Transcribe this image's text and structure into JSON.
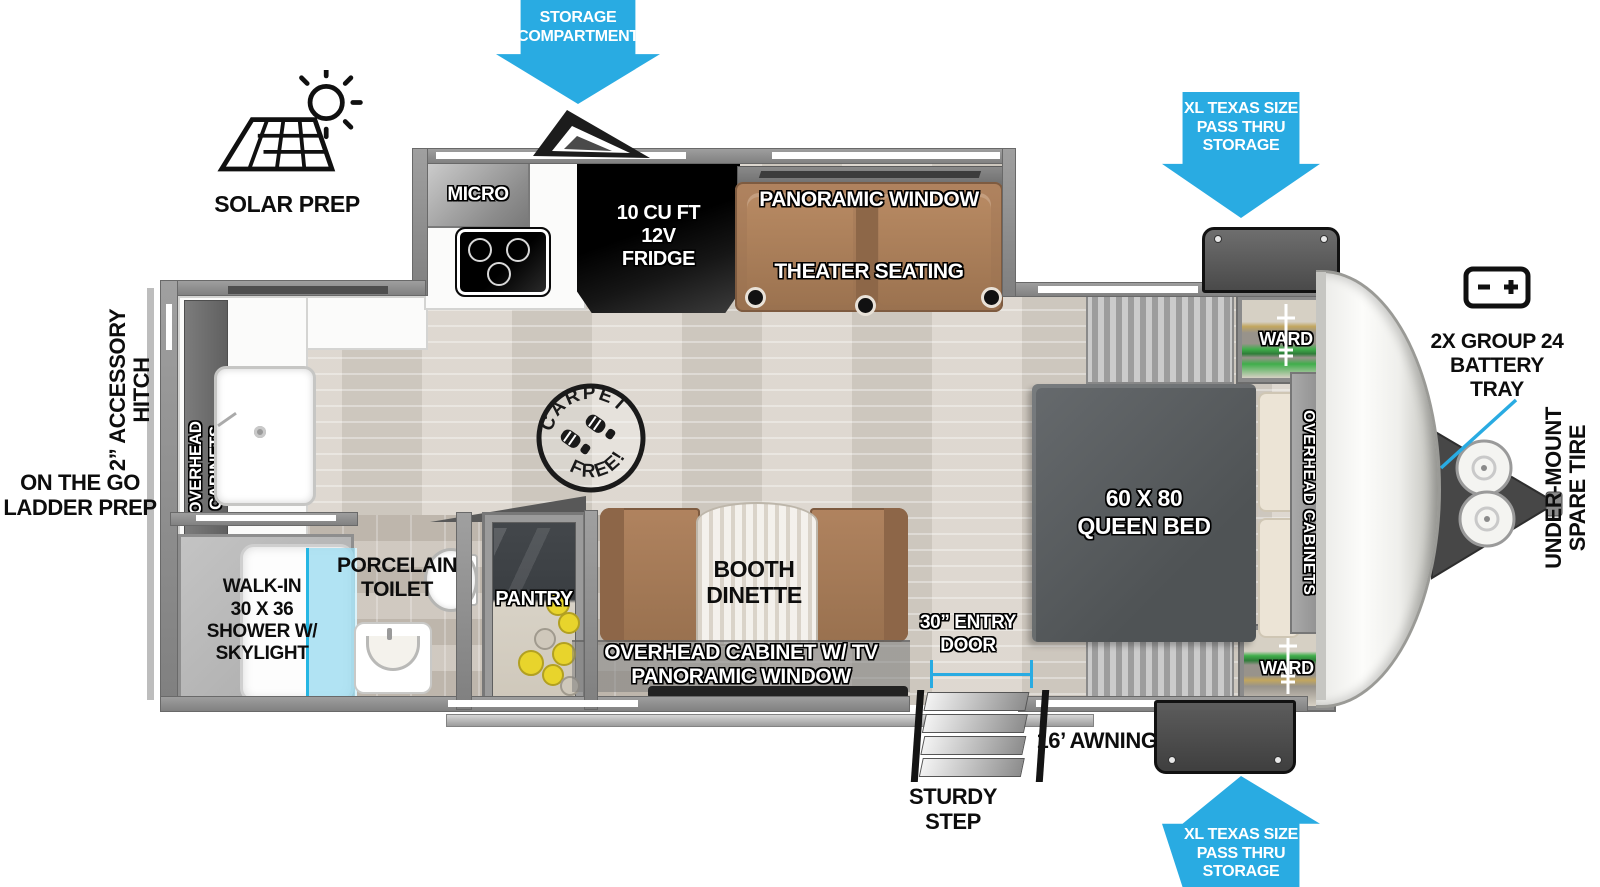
{
  "title": "Travel Trailer Floorplan",
  "colors": {
    "arrow_blue": "#29abe2",
    "wall_gray": "#8f8f8f",
    "bed_gray": "#585c5e",
    "seat_brown": "#a57a5b",
    "can_yellow": "#e8d42c",
    "shower_glass_blue": "#9fdcf0"
  },
  "callouts": {
    "storage_compartment": {
      "line1": "STORAGE",
      "line2": "COMPARTMENT"
    },
    "pass_thru_top": {
      "line1": "XL TEXAS SIZE",
      "line2": "PASS THRU",
      "line3": "STORAGE"
    },
    "pass_thru_bottom": {
      "line1": "XL TEXAS SIZE",
      "line2": "PASS THRU",
      "line3": "STORAGE"
    },
    "battery_tray": {
      "line1": "2X GROUP 24",
      "line2": "BATTERY",
      "line3": "TRAY"
    },
    "solar_prep": "SOLAR PREP",
    "accessory_hitch": {
      "line1": "2” ACCESSORY",
      "line2": "HITCH"
    },
    "ladder_prep": {
      "line1": "ON THE GO",
      "line2": "LADDER PREP"
    },
    "spare_tire": {
      "line1": "UNDER-MOUNT",
      "line2": "SPARE TIRE"
    },
    "awning": "16’ AWNING",
    "sturdy_step": {
      "line1": "STURDY",
      "line2": "STEP"
    },
    "entry_door": {
      "line1": "30” ENTRY",
      "line2": "DOOR"
    }
  },
  "stamp": {
    "arc_top": "CARPET",
    "arc_bottom": "FREE!"
  },
  "galley": {
    "micro": "MICRO",
    "fridge": {
      "line1": "10 CU FT",
      "line2": "12V",
      "line3": "FRIDGE"
    },
    "rear_overhead": {
      "line1": "OVERHEAD",
      "line2": "CABINETS"
    },
    "pantry": "PANTRY"
  },
  "living": {
    "panoramic_window": "PANORAMIC WINDOW",
    "theater_seating": "THEATER SEATING",
    "booth_dinette": {
      "line1": "BOOTH",
      "line2": "DINETTE"
    },
    "overhead_cabinet_tv": "OVERHEAD CABINET W/ TV",
    "panoramic_window_lower": "PANORAMIC WINDOW"
  },
  "bedroom": {
    "queen_bed": {
      "line1": "60 X 80",
      "line2": "QUEEN BED"
    },
    "ward_top": "WARD",
    "ward_bottom": "WARD",
    "overhead_cabinets": "OVERHEAD CABINETS"
  },
  "bathroom": {
    "shower": {
      "line1": "WALK-IN",
      "line2": "30 X 36",
      "line3": "SHOWER W/",
      "line4": "SKYLIGHT"
    },
    "toilet": {
      "line1": "PORCELAIN",
      "line2": "TOILET"
    }
  }
}
